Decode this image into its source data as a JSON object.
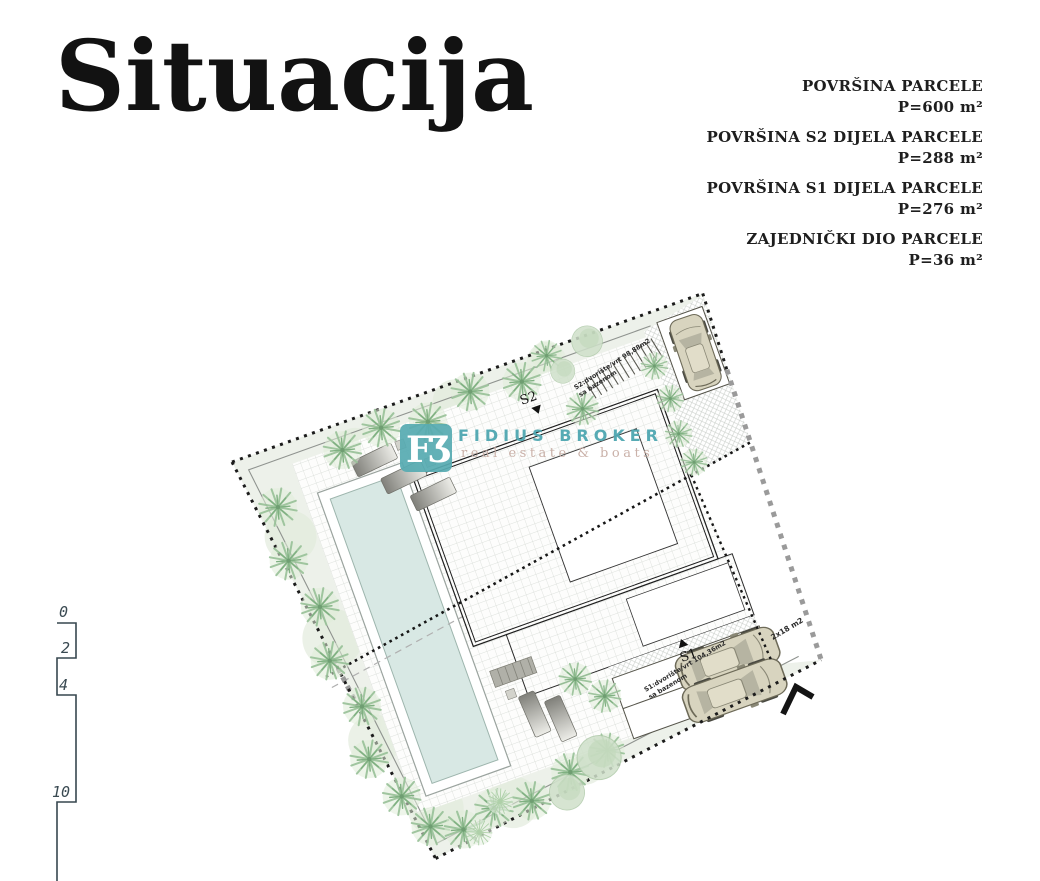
{
  "title": "Situacija",
  "areas": [
    {
      "label": "POVRŠINA PARCELE",
      "value": "P=600 m²"
    },
    {
      "label": "POVRŠINA S2 DIJELA PARCELE",
      "value": "P=288 m²"
    },
    {
      "label": "POVRŠINA S1 DIJELA PARCELE",
      "value": "P=276 m²"
    },
    {
      "label": "ZAJEDNIČKI DIO PARCELE",
      "value": "P=36 m²"
    }
  ],
  "scale_bar": {
    "ticks": [
      "0",
      "2",
      "4",
      "10"
    ]
  },
  "plan": {
    "s2_label": "S2",
    "s1_label": "S1",
    "s2_caption_line1": "S2:dvorište/vrt 98,88m2",
    "s2_caption_line2": "sa bazenom",
    "s1_caption_line1": "S1:dvorište/vrt 104,36m2",
    "s1_caption_line2": "sa bazenom",
    "parking_area_label": "2x18 m2"
  },
  "watermark": {
    "logo_text": "FƷ",
    "name": "FIDIUS BROKER",
    "tagline": "real estate & boats",
    "brand_color": "#57abb2",
    "tagline_color": "#c6aba2"
  },
  "colors": {
    "pool_water": "#d8e8e4",
    "parcel_ground": "#edf1ea",
    "greenery": "#9cc29c",
    "car_body": "#d8d4bf",
    "boundary": "#1c1c1c",
    "outer_boundary_dash": "#9a9a9a"
  }
}
